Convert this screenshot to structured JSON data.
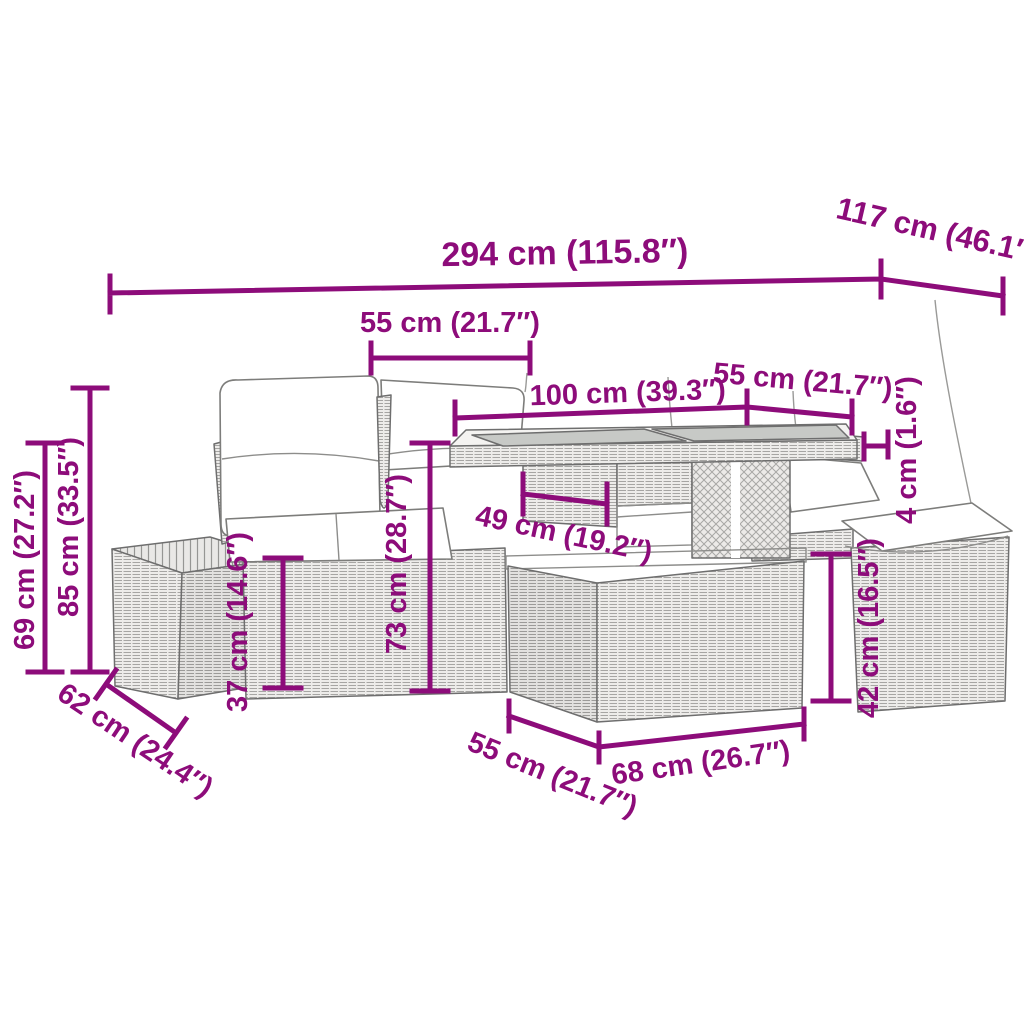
{
  "illustration": {
    "alt": "line drawing of a rattan garden lounge set: two-seater sofa with cushions, two stools, and a storage table with glass top",
    "accent_color": "#8D0C7A",
    "line_color": "#6e6e6e"
  },
  "dimensions": {
    "overall_width": "294 cm (115.8″)",
    "overall_depth": "117 cm (46.1″)",
    "seat_width": "55 cm (21.7″)",
    "table_length": "100 cm (39.3″)",
    "table_width": "55 cm (21.7″)",
    "tabletop_thickness": "4 cm (1.6″)",
    "armrest_height": "69 cm (27.2″)",
    "back_height": "85 cm (33.5″)",
    "seat_height": "37 cm (14.6″)",
    "table_height": "73 cm (28.7″)",
    "table_inner_depth": "49 cm (19.2″)",
    "stool_depth": "62 cm (24.4″)",
    "base_width_left": "55 cm (21.7″)",
    "base_width_right": "68 cm (26.7″)",
    "stool_height": "42 cm (16.5″)"
  }
}
